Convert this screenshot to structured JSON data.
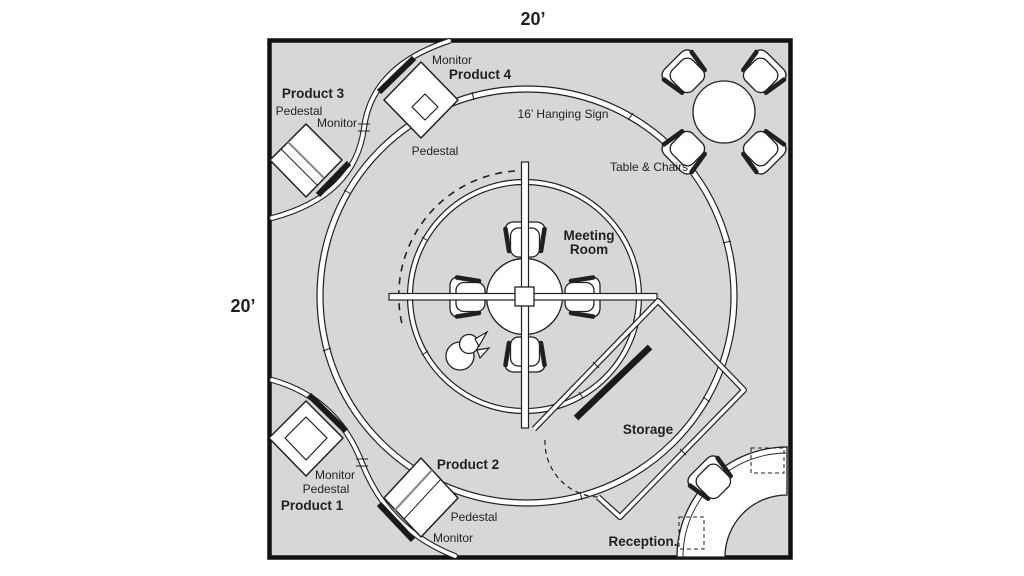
{
  "booth": {
    "width_label": "20’",
    "depth_label": "20’"
  },
  "areas": {
    "hanging_sign": "16’ Hanging Sign",
    "table_chairs": "Table & Chairs",
    "meeting_room": [
      "Meeting",
      "Room"
    ],
    "storage": "Storage",
    "reception": "Reception."
  },
  "products": [
    {
      "name": "Product 1",
      "monitor_label": "Monitor",
      "pedestal_label": "Pedestal"
    },
    {
      "name": "Product 2",
      "monitor_label": "Monitor",
      "pedestal_label": "Pedestal"
    },
    {
      "name": "Product 3",
      "monitor_label": "Monitor",
      "pedestal_label": "Pedestal"
    },
    {
      "name": "Product 4",
      "monitor_label": "Monitor",
      "pedestal_label": "Pedestal"
    }
  ],
  "colors": {
    "floor": "#d7d7d7",
    "line": "#231f20",
    "wall": "#ffffff"
  }
}
